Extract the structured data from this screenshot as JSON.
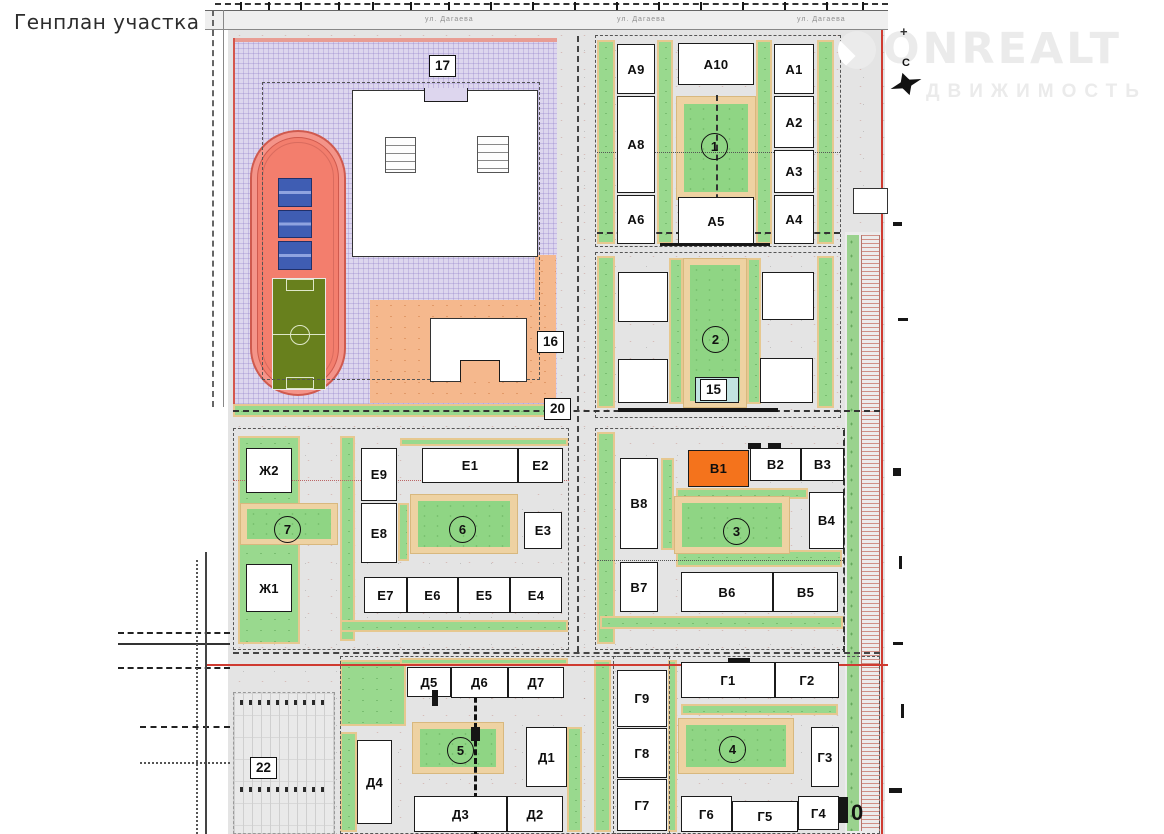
{
  "page": {
    "title": "Генплан участка"
  },
  "watermark": {
    "brand": "ONREALT",
    "subtitle": "ДВИЖИМОСТЬ"
  },
  "compass": {
    "north": "С"
  },
  "streets": {
    "top_name": "ул. Дагаева",
    "label_positions_x": [
      425,
      617,
      797
    ]
  },
  "legend_colors": {
    "highlighted_building": "#f4731c",
    "residential_building": "#ffffff",
    "lawn_green": "#99d98e",
    "path_tan": "#eed2a2",
    "school_zone_purple": "#ddd6ee",
    "kindergarten_zone_orange": "#f5b88d",
    "track_red": "#f37e6d",
    "teal_building": "#c2e3e1",
    "boundary_red": "#cf3b31"
  },
  "buildings": [
    {
      "label": "А9",
      "x": 617,
      "y": 44,
      "w": 38,
      "h": 50
    },
    {
      "label": "А10",
      "x": 678,
      "y": 43,
      "w": 76,
      "h": 42
    },
    {
      "label": "А1",
      "x": 774,
      "y": 44,
      "w": 40,
      "h": 50
    },
    {
      "label": "А8",
      "x": 617,
      "y": 96,
      "w": 38,
      "h": 97
    },
    {
      "label": "А2",
      "x": 774,
      "y": 96,
      "w": 40,
      "h": 52
    },
    {
      "label": "А3",
      "x": 774,
      "y": 150,
      "w": 40,
      "h": 43
    },
    {
      "label": "А6",
      "x": 617,
      "y": 195,
      "w": 38,
      "h": 49
    },
    {
      "label": "А5",
      "x": 678,
      "y": 197,
      "w": 76,
      "h": 48
    },
    {
      "label": "А4",
      "x": 774,
      "y": 195,
      "w": 40,
      "h": 49
    },
    {
      "label": "",
      "x": 618,
      "y": 272,
      "w": 50,
      "h": 50
    },
    {
      "label": "",
      "x": 762,
      "y": 272,
      "w": 52,
      "h": 48
    },
    {
      "label": "",
      "x": 618,
      "y": 359,
      "w": 50,
      "h": 44
    },
    {
      "label": "",
      "x": 760,
      "y": 358,
      "w": 53,
      "h": 45
    },
    {
      "label": "",
      "x": 695,
      "y": 377,
      "w": 44,
      "h": 26,
      "cls": "teal"
    },
    {
      "label": "В1",
      "x": 688,
      "y": 450,
      "w": 61,
      "h": 37,
      "cls": "hl"
    },
    {
      "label": "В2",
      "x": 750,
      "y": 448,
      "w": 51,
      "h": 33
    },
    {
      "label": "В3",
      "x": 801,
      "y": 448,
      "w": 43,
      "h": 33
    },
    {
      "label": "В8",
      "x": 620,
      "y": 458,
      "w": 38,
      "h": 91
    },
    {
      "label": "В4",
      "x": 809,
      "y": 492,
      "w": 35,
      "h": 57
    },
    {
      "label": "В7",
      "x": 620,
      "y": 562,
      "w": 38,
      "h": 50
    },
    {
      "label": "В6",
      "x": 681,
      "y": 572,
      "w": 92,
      "h": 40
    },
    {
      "label": "В5",
      "x": 773,
      "y": 572,
      "w": 65,
      "h": 40
    },
    {
      "label": "Ж2",
      "x": 246,
      "y": 448,
      "w": 46,
      "h": 45
    },
    {
      "label": "Е9",
      "x": 361,
      "y": 448,
      "w": 36,
      "h": 53
    },
    {
      "label": "Е1",
      "x": 422,
      "y": 448,
      "w": 96,
      "h": 35
    },
    {
      "label": "Е2",
      "x": 518,
      "y": 448,
      "w": 45,
      "h": 35
    },
    {
      "label": "Е8",
      "x": 361,
      "y": 503,
      "w": 36,
      "h": 60
    },
    {
      "label": "Е3",
      "x": 524,
      "y": 512,
      "w": 38,
      "h": 37
    },
    {
      "label": "Ж1",
      "x": 246,
      "y": 564,
      "w": 46,
      "h": 48
    },
    {
      "label": "Е7",
      "x": 364,
      "y": 577,
      "w": 43,
      "h": 36
    },
    {
      "label": "Е6",
      "x": 407,
      "y": 577,
      "w": 51,
      "h": 36
    },
    {
      "label": "Е5",
      "x": 458,
      "y": 577,
      "w": 52,
      "h": 36
    },
    {
      "label": "Е4",
      "x": 510,
      "y": 577,
      "w": 52,
      "h": 36
    },
    {
      "label": "Д5",
      "x": 407,
      "y": 667,
      "w": 44,
      "h": 30
    },
    {
      "label": "Д6",
      "x": 451,
      "y": 667,
      "w": 57,
      "h": 31
    },
    {
      "label": "Д7",
      "x": 508,
      "y": 667,
      "w": 56,
      "h": 31
    },
    {
      "label": "Д1",
      "x": 526,
      "y": 727,
      "w": 41,
      "h": 60
    },
    {
      "label": "Д4",
      "x": 357,
      "y": 740,
      "w": 35,
      "h": 84
    },
    {
      "label": "Д3",
      "x": 414,
      "y": 796,
      "w": 93,
      "h": 36
    },
    {
      "label": "Д2",
      "x": 507,
      "y": 796,
      "w": 56,
      "h": 36
    },
    {
      "label": "Г9",
      "x": 617,
      "y": 670,
      "w": 50,
      "h": 57
    },
    {
      "label": "Г8",
      "x": 617,
      "y": 728,
      "w": 50,
      "h": 50
    },
    {
      "label": "Г7",
      "x": 617,
      "y": 779,
      "w": 50,
      "h": 52
    },
    {
      "label": "Г1",
      "x": 681,
      "y": 662,
      "w": 94,
      "h": 36
    },
    {
      "label": "Г2",
      "x": 775,
      "y": 662,
      "w": 64,
      "h": 36
    },
    {
      "label": "Г3",
      "x": 811,
      "y": 727,
      "w": 28,
      "h": 60
    },
    {
      "label": "Г6",
      "x": 681,
      "y": 796,
      "w": 51,
      "h": 36
    },
    {
      "label": "Г5",
      "x": 732,
      "y": 801,
      "w": 66,
      "h": 31
    },
    {
      "label": "Г4",
      "x": 798,
      "y": 796,
      "w": 41,
      "h": 34
    },
    {
      "label": "",
      "x": 352,
      "y": 90,
      "w": 186,
      "h": 167,
      "cls": "thin"
    },
    {
      "label": "",
      "x": 430,
      "y": 318,
      "w": 97,
      "h": 64,
      "cls": "thin"
    },
    {
      "label": "",
      "x": 853,
      "y": 188,
      "w": 35,
      "h": 26,
      "cls": "thin"
    }
  ],
  "zone_boxes": [
    {
      "label": "17",
      "x": 429,
      "y": 55
    },
    {
      "label": "16",
      "x": 537,
      "y": 331
    },
    {
      "label": "20",
      "x": 544,
      "y": 398
    },
    {
      "label": "15",
      "x": 700,
      "y": 379
    },
    {
      "label": "22",
      "x": 250,
      "y": 757
    }
  ],
  "plain_labels": [
    {
      "label": "0",
      "x": 851,
      "y": 800
    }
  ],
  "circle_markers": [
    {
      "label": "1",
      "cx": 714,
      "cy": 146
    },
    {
      "label": "2",
      "cx": 715,
      "cy": 339
    },
    {
      "label": "3",
      "cx": 736,
      "cy": 531
    },
    {
      "label": "4",
      "cx": 732,
      "cy": 749
    },
    {
      "label": "5",
      "cx": 460,
      "cy": 750
    },
    {
      "label": "6",
      "cx": 462,
      "cy": 529
    },
    {
      "label": "7",
      "cx": 287,
      "cy": 529
    }
  ]
}
